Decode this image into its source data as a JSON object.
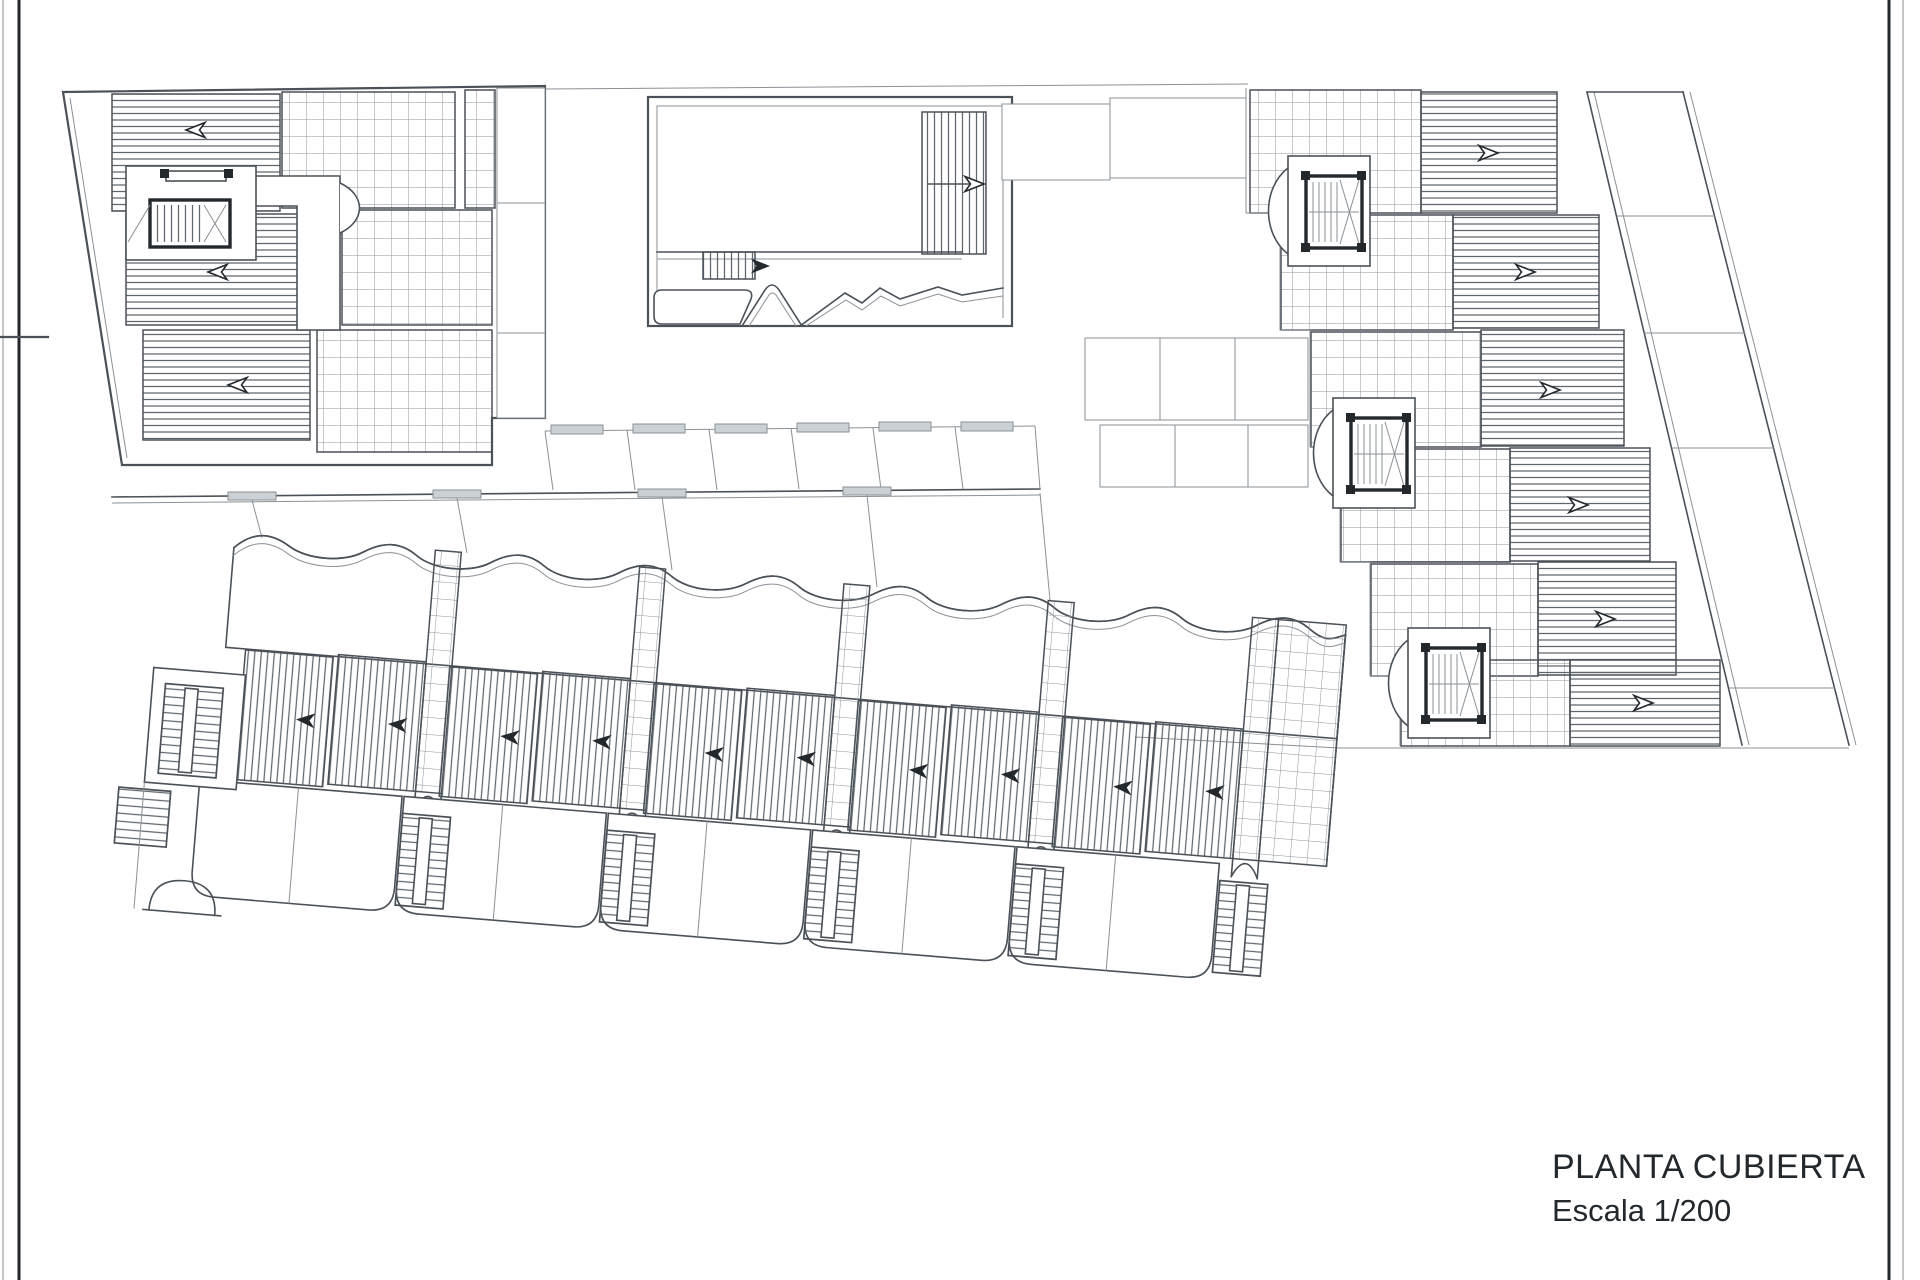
{
  "title_block": {
    "title": "PLANTA CUBIERTA",
    "scale_label": "Escala 1/200"
  },
  "colors": {
    "paper": "#ffffff",
    "ink": "#4b5158",
    "ink_light": "#8a9197",
    "ink_dark": "#23282d",
    "hatch": "#5f676e",
    "grid": "#8d949b",
    "lintel": "#ccd1d5"
  }
}
